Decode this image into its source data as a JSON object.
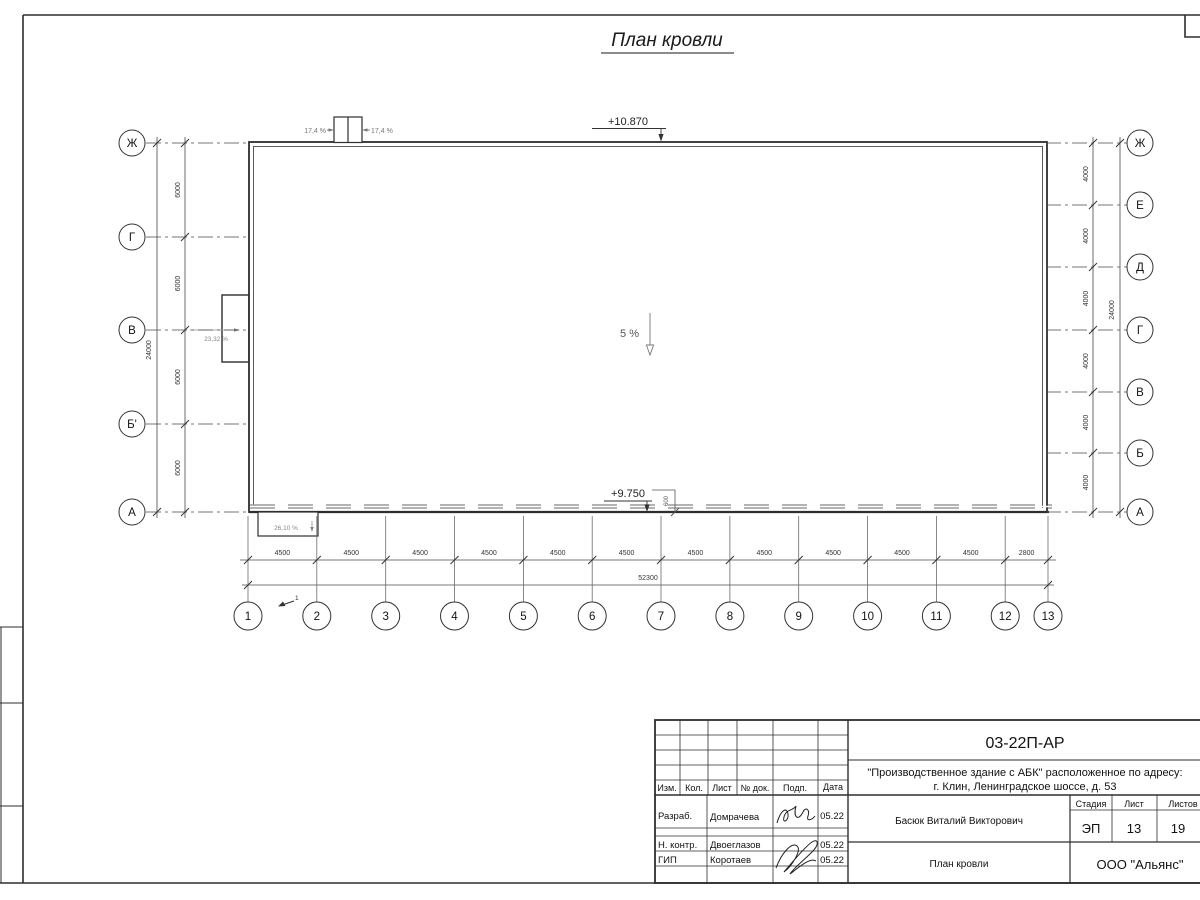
{
  "sheet_title": "План кровли",
  "plan": {
    "elevation_top": "+10.870",
    "elevation_bottom": "+9.750",
    "slope_main": "5 %",
    "slope_top_left": "17,4 %",
    "slope_top_right": "17,4 %",
    "slope_left": "23,32 %",
    "slope_bottom_left": "26,10 %",
    "canopy_offset": "600",
    "section_mark": "1",
    "axes": {
      "left": {
        "labels": [
          "Ж",
          "Г",
          "В",
          "Б'",
          "А"
        ],
        "segment_dims": [
          "6000",
          "6000",
          "6000",
          "6000"
        ],
        "total_dim": "24000"
      },
      "right": {
        "labels": [
          "Ж",
          "Е",
          "Д",
          "Г",
          "В",
          "Б",
          "А"
        ],
        "segment_dims": [
          "4000",
          "4000",
          "4000",
          "4000",
          "4000",
          "4000"
        ],
        "total_dim": "24000"
      },
      "bottom": {
        "labels": [
          "1",
          "2",
          "3",
          "4",
          "5",
          "6",
          "7",
          "8",
          "9",
          "10",
          "11",
          "12",
          "13"
        ],
        "segment_dims": [
          "4500",
          "4500",
          "4500",
          "4500",
          "4500",
          "4500",
          "4500",
          "4500",
          "4500",
          "4500",
          "4500",
          "2800"
        ],
        "total_dim": "52300"
      }
    }
  },
  "title_block": {
    "doc_number": "03-22П-АР",
    "project_line1": "\"Производственное здание с АБК\" расположенное по адресу:",
    "project_line2": "г. Клин, Ленинградское шоссе, д. 53",
    "col_headers": [
      "Изм.",
      "Кол.",
      "Лист",
      "№ док.",
      "Подп.",
      "Дата"
    ],
    "rows": [
      {
        "role": "Разраб.",
        "name": "Домрачева",
        "date": "05.22"
      },
      {
        "role": "Н. контр.",
        "name": "Двоеглазов",
        "date": "05.22"
      },
      {
        "role": "ГИП",
        "name": "Коротаев",
        "date": "05.22"
      }
    ],
    "client": "Басюк Виталий Викторович",
    "stage_label": "Стадия",
    "sheet_label": "Лист",
    "sheets_label": "Листов",
    "stage": "ЭП",
    "sheet_number": "13",
    "sheets_total": "19",
    "drawing_title": "План кровли",
    "company": "ООО \"Альянс\""
  }
}
